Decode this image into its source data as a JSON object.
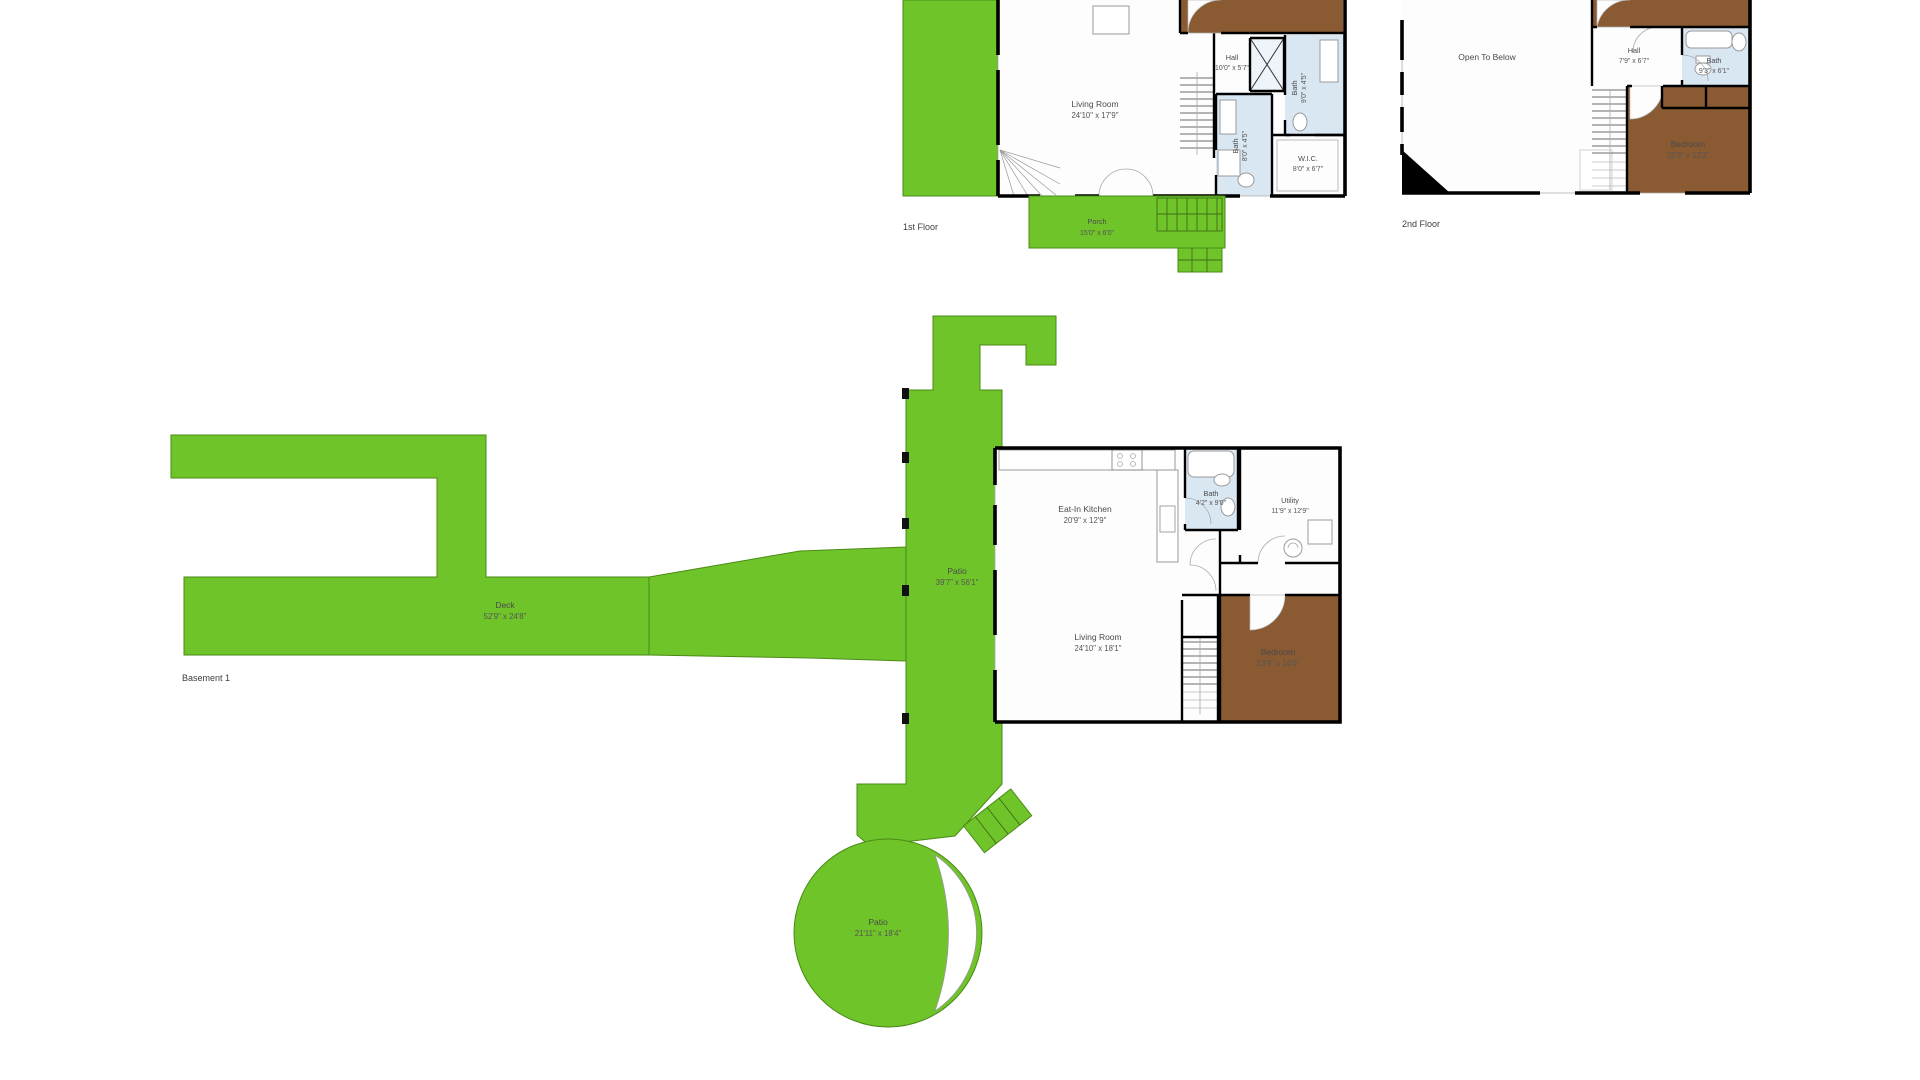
{
  "document_type": "residential floor plan sheet",
  "colors": {
    "outdoor_green": "#6fc42a",
    "bedroom_brown": "#8a5a33",
    "bath_blue": "#d9e7f3",
    "wall_black": "#000000",
    "label_gray": "#4a4a4a",
    "background": "#ffffff"
  },
  "floor1": {
    "caption": "1st Floor",
    "rooms": {
      "living_room": {
        "name": "Living Room",
        "dims": "24'10\" x 17'9\""
      },
      "hall": {
        "name": "Hall",
        "dims": "10'0\" x 5'7\""
      },
      "bath_upper": {
        "name": "Bath",
        "dims": "9'0\" x 4'5\""
      },
      "bath_lower": {
        "name": "Bath",
        "dims": "8'0\" x 4'5\""
      },
      "wic": {
        "name": "W.I.C.",
        "dims": "8'0\" x 6'7\""
      },
      "porch": {
        "name": "Porch",
        "dims": "15'0\" x 6'0\""
      }
    }
  },
  "floor2": {
    "caption": "2nd Floor",
    "rooms": {
      "open_to_below": {
        "name": "Open To Below"
      },
      "hall": {
        "name": "Hall",
        "dims": "7'9\" x 6'7\""
      },
      "bath": {
        "name": "Bath",
        "dims": "9'3\" x 6'1\""
      },
      "bedroom": {
        "name": "Bedroom",
        "dims": "15'3\" x 12'3\""
      }
    }
  },
  "basement": {
    "caption": "Basement 1",
    "rooms": {
      "deck": {
        "name": "Deck",
        "dims": "52'9\" x 24'8\""
      },
      "patio": {
        "name": "Patio",
        "dims": "39'7\" x 56'1\""
      },
      "patio_round": {
        "name": "Patio",
        "dims": "21'11\" x 18'4\""
      },
      "kitchen": {
        "name": "Eat-In Kitchen",
        "dims": "20'9\" x 12'9\""
      },
      "bath": {
        "name": "Bath",
        "dims": "4'2\" x 9'0\""
      },
      "utility": {
        "name": "Utility",
        "dims": "11'9\" x 12'9\""
      },
      "living_room": {
        "name": "Living Room",
        "dims": "24'10\" x 18'1\""
      },
      "bedroom": {
        "name": "Bedroom",
        "dims": "13'9\" x 14'0\""
      }
    }
  }
}
